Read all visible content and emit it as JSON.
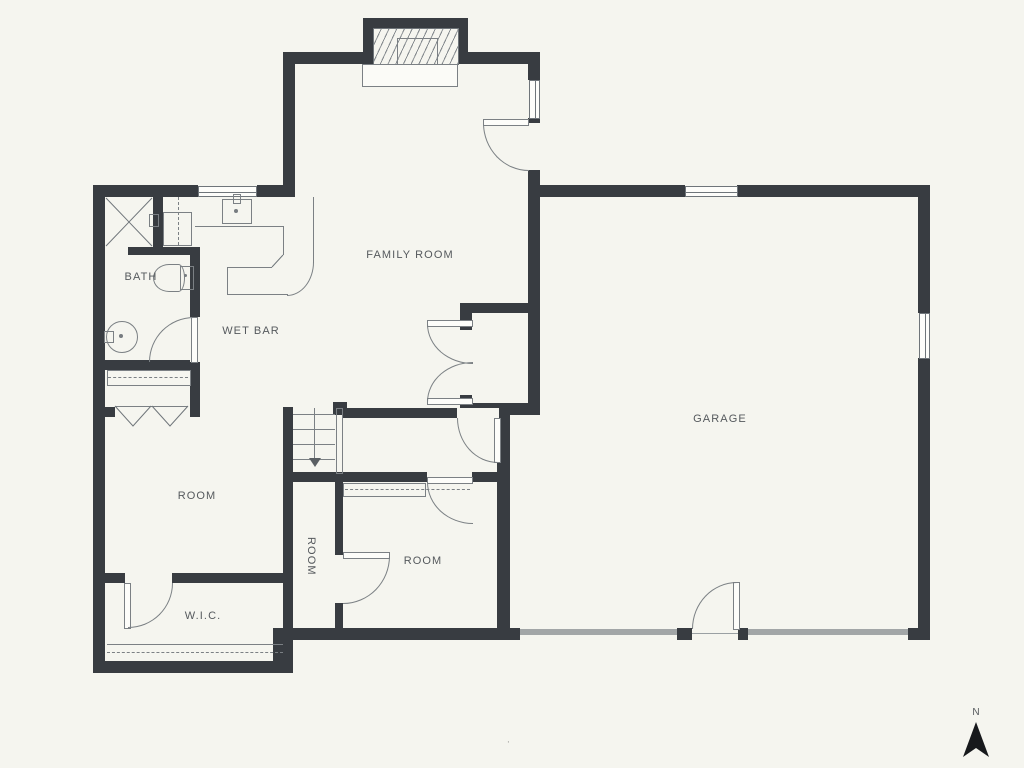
{
  "plan": {
    "labels": {
      "family_room": "FAMILY ROOM",
      "bath": "BATH",
      "wet_bar": "WET BAR",
      "garage": "GARAGE",
      "room_left": "ROOM",
      "room_small": "ROOM",
      "room_bottom": "ROOM",
      "wic": "W.I.C."
    },
    "compass": {
      "north_label": "N"
    },
    "footer_mark": "·",
    "colors": {
      "wall": "#383c41",
      "background": "#f5f5ef",
      "line": "#7b8084",
      "garage_door": "#a2a6a7",
      "text": "#55595d"
    }
  }
}
